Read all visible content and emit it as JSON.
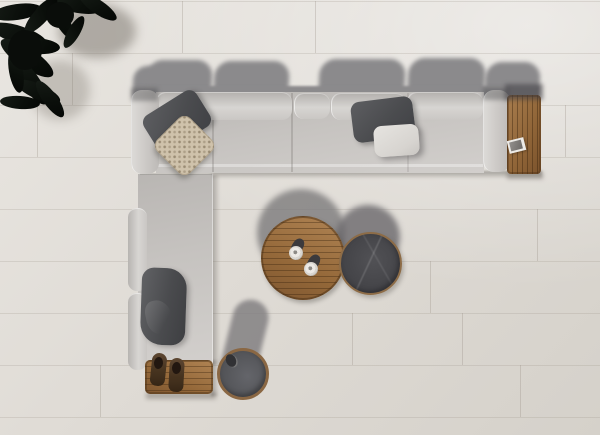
{
  "scene": {
    "type": "photograph",
    "view": "top-down aerial",
    "setting": "outdoor terrace, off-white large-format tile floor, hard light casting shadows upward",
    "objects": [
      {
        "name": "l-shaped-modular-sofa",
        "upholstery": "light gray",
        "orientation": "top run horizontal, left run vertical"
      },
      {
        "name": "teak-slat-end-table",
        "position": "right end of sofa",
        "items": [
          "small-magazine"
        ]
      },
      {
        "name": "teak-slat-platform",
        "position": "bottom end of left sofa run",
        "items": [
          "pair-of-dark-clogs"
        ]
      },
      {
        "name": "round-teak-coffee-table",
        "position": "center",
        "items": [
          "espresso-cup",
          "espresso-cup"
        ]
      },
      {
        "name": "round-dark-stone-side-table",
        "position": "right of coffee table"
      },
      {
        "name": "round-stool-teak-rim",
        "position": "bottom center, with grab hole"
      },
      {
        "name": "throw-pillow-charcoal",
        "count": 3
      },
      {
        "name": "throw-pillow-white",
        "count": 1
      },
      {
        "name": "throw-pillow-knitted-beige",
        "count": 1
      },
      {
        "name": "potted-plant-dark-foliage",
        "position": "top-left corner"
      }
    ]
  },
  "palette": {
    "floor": "#ded9d3",
    "floorLine": "#cbc6be",
    "sofa": "#c7c4c1",
    "sofaLight": "#d8d6d3",
    "sofaShade": "#b2afac",
    "shadow": "#8b8a8c",
    "shadowDark": "#6f6e72",
    "pillowDark": "#4f5053",
    "pillowWhite": "#dedcd8",
    "pillowKnit": "#cfc2ab",
    "wood": "#946839",
    "woodDark": "#6f4e2d",
    "woodLight": "#b08454",
    "tableDarkTop": "#48484c",
    "stoolTop": "#595a5e",
    "plant": "#0c100c",
    "clog": "#46331f",
    "cup": "#ece9e5"
  }
}
